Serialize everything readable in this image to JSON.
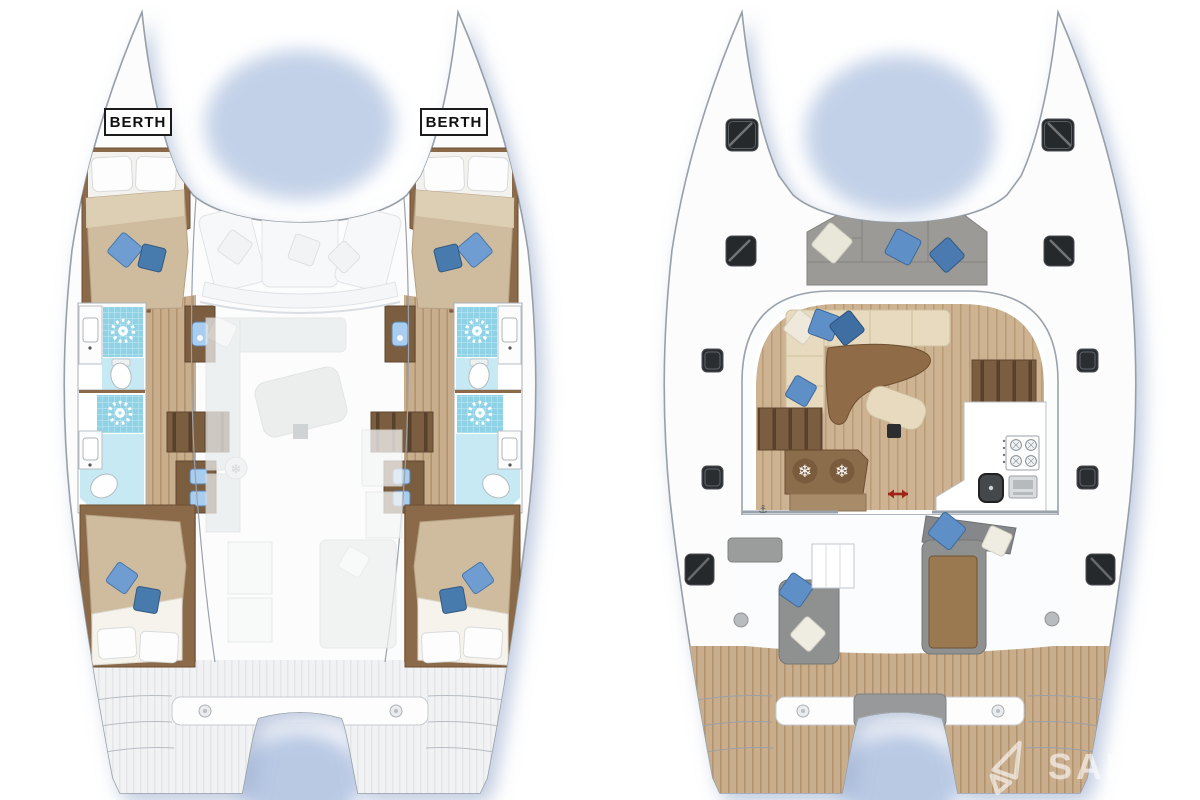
{
  "interior_plan": {
    "berth_labels": {
      "port": "BERTH",
      "starboard": "BERTH"
    }
  },
  "deck_plan": {
    "galley": [
      "stove-4-burner",
      "oven",
      "sink"
    ],
    "fridge_count": 2
  },
  "watermark": {
    "text": "SAILIC",
    "logo": "folded-sail-logo"
  },
  "icons": {
    "freezer_glyph": "❄",
    "anchor_glyph": "⚓",
    "shower": "sunburst-showerhead",
    "freezer": "snowflake"
  },
  "colors": {
    "background": "#ffffff",
    "hull_outline": "#97a0a8",
    "shadow_blue": "#8fa3c8",
    "teak": "#c9ae8d",
    "teak_stripe": "#b3926e",
    "dark_wood": "#7b5d40",
    "duvet_tan": "#cfbc9f",
    "sofa_cream": "#e7dabe",
    "pillow_blue": "#5e8fc6",
    "pillow_blue_dark": "#3f6ea3",
    "shower_blue": "#8fd2e5",
    "shower_tile_light": "#c6e9f3",
    "cushion_gray": "#9b9a96",
    "hatch_dark": "#26292c",
    "arrow_red": "#a02318"
  }
}
